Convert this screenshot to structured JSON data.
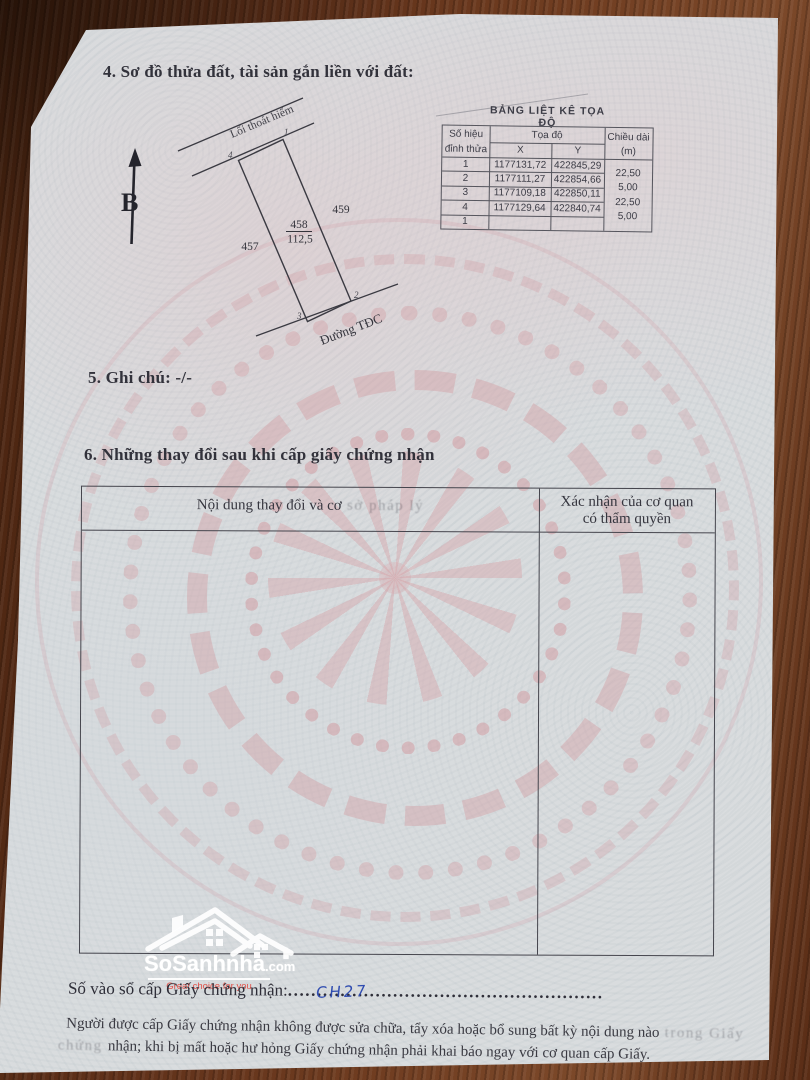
{
  "sections": {
    "s4": "4. Sơ đồ thửa đất, tài sản gắn liền với đất:",
    "s5": "5. Ghi chú: -/-",
    "s6": "6. Những thay đổi sau khi cấp giấy chứng nhận"
  },
  "diagram": {
    "north_label": "B",
    "road_top": "Lối thoát hiểm",
    "road_bottom": "Đường TĐC",
    "parcel_number": "458",
    "parcel_area": "112,5",
    "neighbor_left": "457",
    "neighbor_right": "459",
    "v1": "1",
    "v2": "2",
    "v3": "3",
    "v4": "4"
  },
  "coord_table": {
    "title": "BẢNG LIỆT KÊ TỌA ĐỘ",
    "h_vertex1": "Số hiệu",
    "h_vertex2": "đỉnh thửa",
    "h_coords": "Tọa độ",
    "h_x": "X",
    "h_y": "Y",
    "h_len1": "Chiều dài",
    "h_len2": "(m)",
    "rows": [
      {
        "v": "1",
        "x": "1177131,72",
        "y": "422845,29"
      },
      {
        "v": "2",
        "x": "1177111,27",
        "y": "422854,66"
      },
      {
        "v": "3",
        "x": "1177109,18",
        "y": "422850,11"
      },
      {
        "v": "4",
        "x": "1177129,64",
        "y": "422840,74"
      },
      {
        "v": "1",
        "x": "",
        "y": ""
      }
    ],
    "lengths": [
      "22,50",
      "5,00",
      "22,50",
      "5,00"
    ]
  },
  "changes_table": {
    "col1_main": "Nội dung thay đổi và cơ",
    "col1_faded": " sở pháp lý",
    "col2_line1": "Xác nhận của cơ quan",
    "col2_line2": "có thẩm quyền"
  },
  "logo": {
    "brand": "SoSanhnha",
    "tld": ".com",
    "tagline": "Great choice for you"
  },
  "footer": {
    "registry_label": "Số vào sổ cấp Giấy chứng nhận:",
    "registry_dots": "......................................................",
    "registry_value": "CH27",
    "legal1_main": "Người được cấp Giấy chứng nhận không được sửa chữa, tẩy xóa hoặc bổ sung bất kỳ nội dung nào",
    "legal1_faded": " trong Giấy",
    "legal2_faded": "chứng ",
    "legal2_main": "nhận; khi bị mất hoặc hư hỏng Giấy chứng nhận phải khai báo ngay với cơ quan cấp Giấy."
  },
  "colors": {
    "ink": "#32323b",
    "pen_blue": "#2f4cb0",
    "logo_red": "#e25148",
    "watermark_pink": "#d49ca1",
    "paper": "#d9dcde",
    "wood": "#6f3c20"
  }
}
